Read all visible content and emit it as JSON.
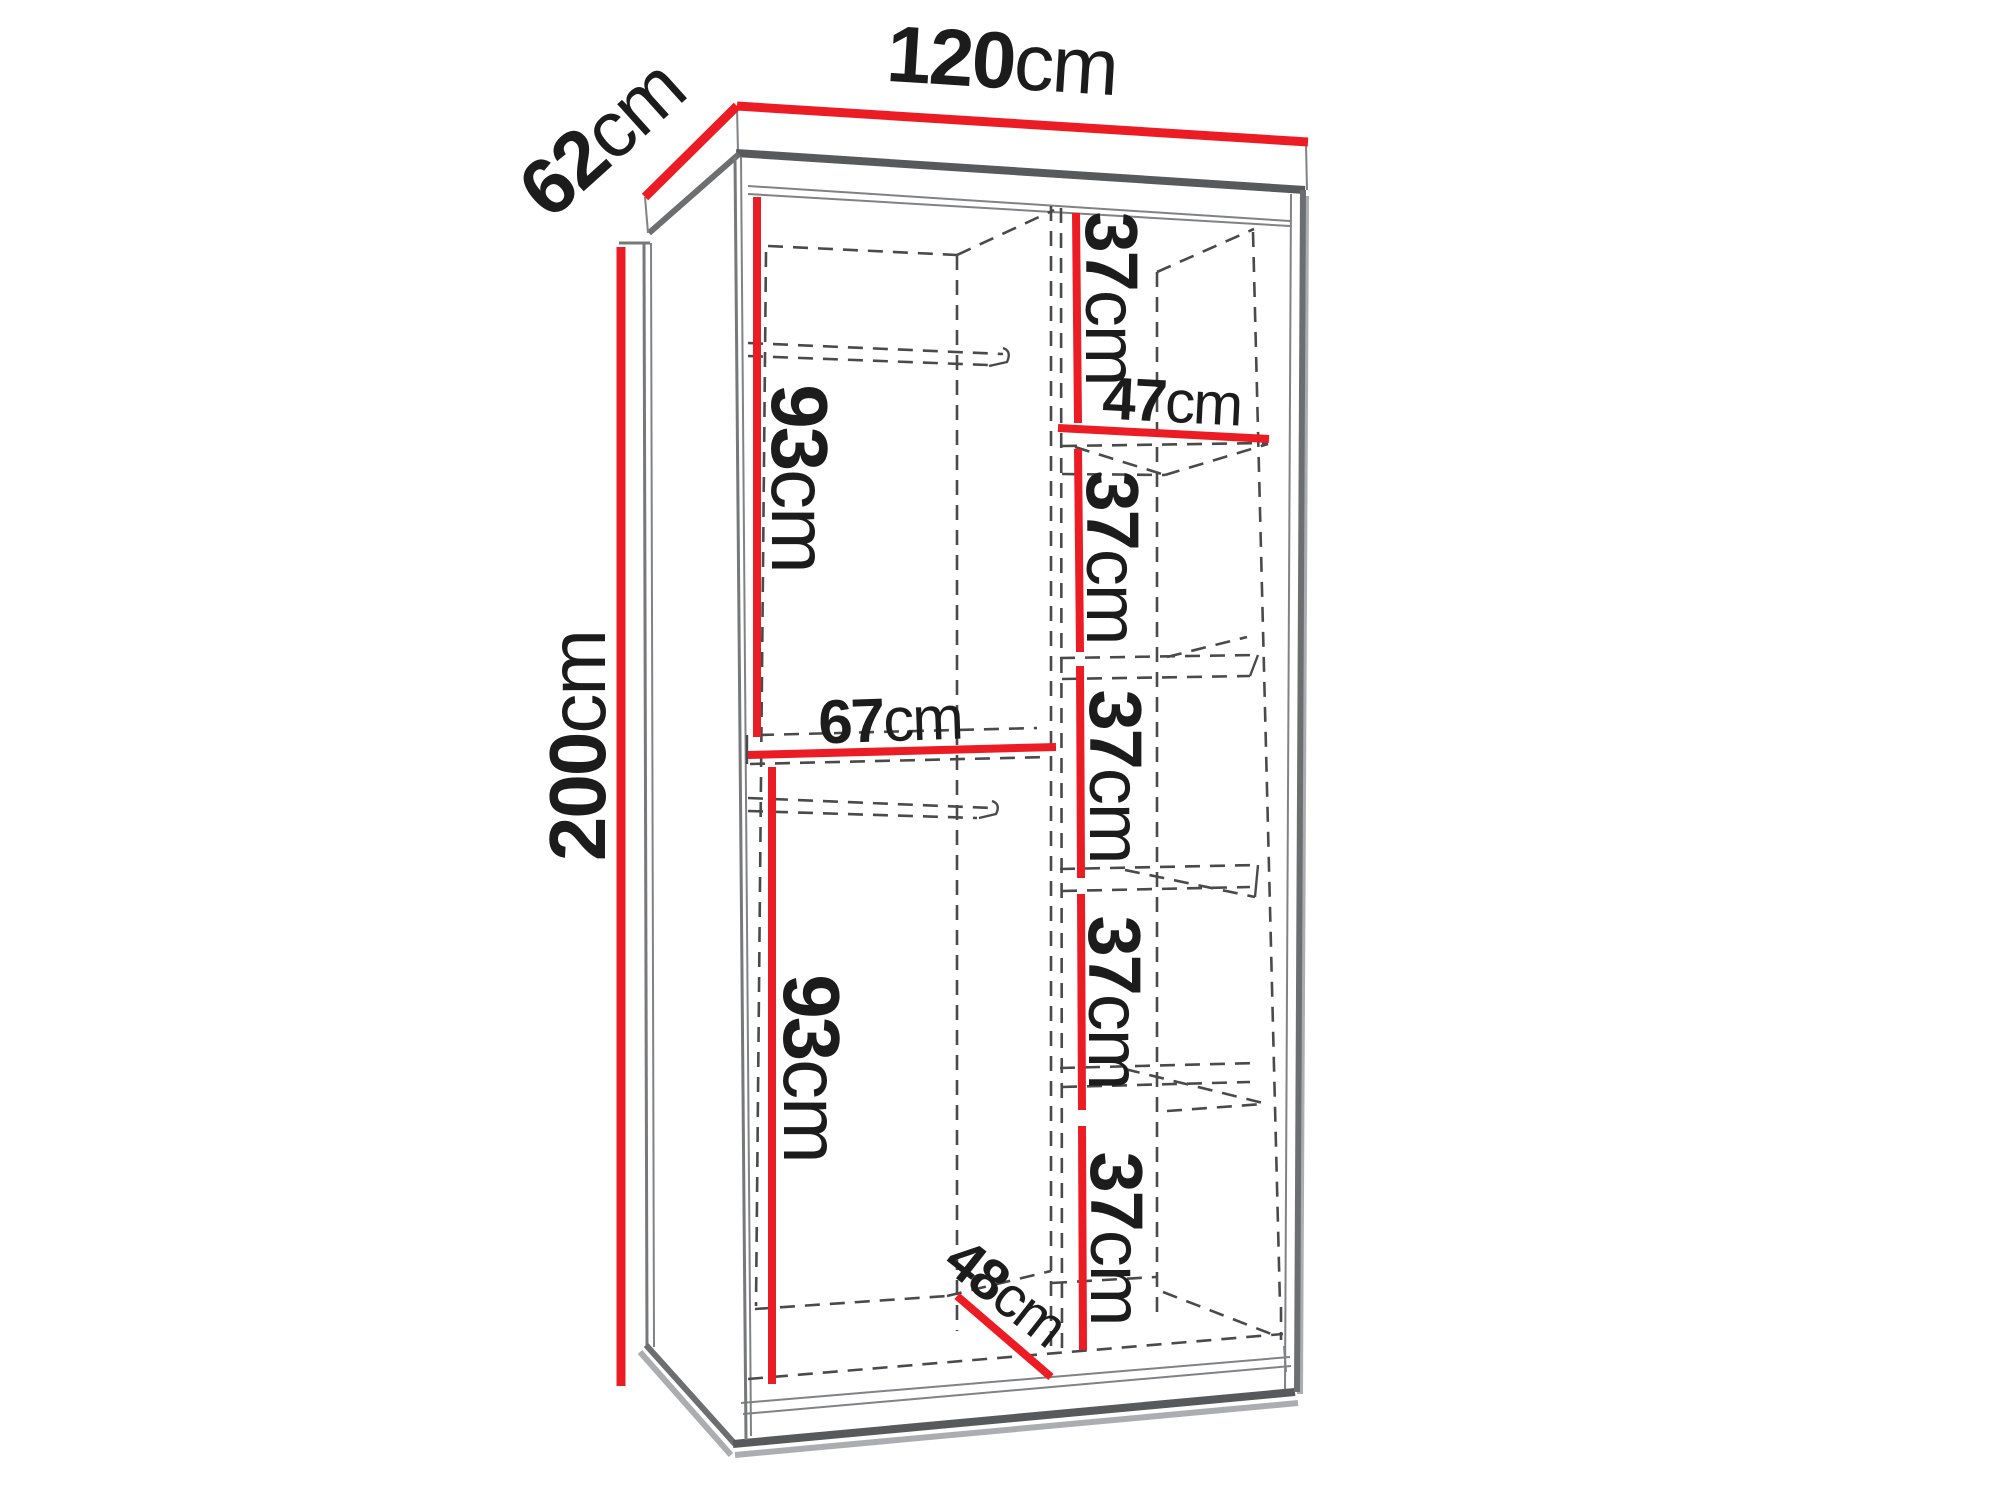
{
  "figure": {
    "kind": "wardrobe-interior-dimension-diagram",
    "unit": "cm"
  },
  "colors": {
    "dimension_red": "#ec1c24",
    "outline_gray": "#58595b",
    "dashed_gray": "#4a4a4a",
    "text_black": "#1c1c1c",
    "background": "#ffffff"
  },
  "labels": {
    "overall_width": {
      "value": "120",
      "unit": "cm"
    },
    "overall_depth": {
      "value": "62",
      "unit": "cm"
    },
    "overall_height": {
      "value": "200",
      "unit": "cm"
    },
    "upper_section_height": {
      "value": "93",
      "unit": "cm"
    },
    "left_section_width": {
      "value": "67",
      "unit": "cm"
    },
    "lower_section_height": {
      "value": "93",
      "unit": "cm"
    },
    "interior_depth": {
      "value": "48",
      "unit": "cm"
    },
    "shelf_width": {
      "value": "47",
      "unit": "cm"
    },
    "shelf_gaps": [
      {
        "value": "37",
        "unit": "cm"
      },
      {
        "value": "37",
        "unit": "cm"
      },
      {
        "value": "37",
        "unit": "cm"
      },
      {
        "value": "37",
        "unit": "cm"
      },
      {
        "value": "37",
        "unit": "cm"
      }
    ]
  }
}
